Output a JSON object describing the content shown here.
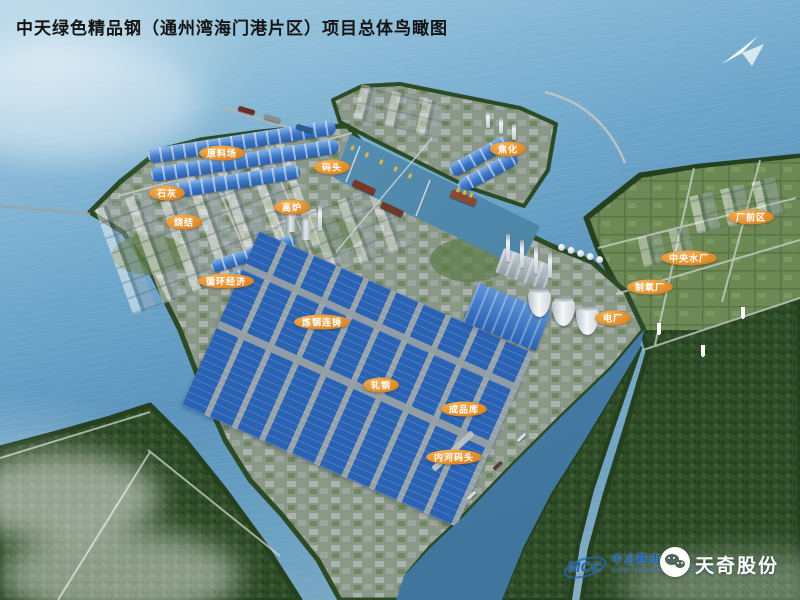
{
  "title": "中天绿色精品钢（通州湾海门港片区）项目总体鸟瞰图",
  "compass": {
    "icon": "north-arrow-icon"
  },
  "map_labels": [
    {
      "id": "raw-material-yard",
      "text": "原料场"
    },
    {
      "id": "dock",
      "text": "码头"
    },
    {
      "id": "lime",
      "text": "石灰"
    },
    {
      "id": "blast-furnace",
      "text": "高炉"
    },
    {
      "id": "sintering",
      "text": "烧结"
    },
    {
      "id": "coking",
      "text": "焦化"
    },
    {
      "id": "circular-economy",
      "text": "循环经济"
    },
    {
      "id": "steelmaking-casting",
      "text": "炼钢连铸"
    },
    {
      "id": "rolling-mill",
      "text": "轧钢"
    },
    {
      "id": "finished-goods-warehouse",
      "text": "成品库"
    },
    {
      "id": "inland-river-dock",
      "text": "内河码头"
    },
    {
      "id": "plant-front-area",
      "text": "厂前区"
    },
    {
      "id": "central-water-plant",
      "text": "中央水厂"
    },
    {
      "id": "oxygen-plant",
      "text": "制氧厂"
    },
    {
      "id": "power-plant",
      "text": "电厂"
    }
  ],
  "branding": {
    "mcc_logo_text": "MCC",
    "company_cn": "中冶赛迪",
    "company_en": "CISDI ENGINEERING CO., LTD",
    "watermark": "天奇股份"
  },
  "colors": {
    "water": "#6ea6cb",
    "forest_green": "#2f4d28",
    "roof_blue": "#2a62b4",
    "label_orange": "#e08f2e",
    "brand_blue": "#1d5fae"
  }
}
